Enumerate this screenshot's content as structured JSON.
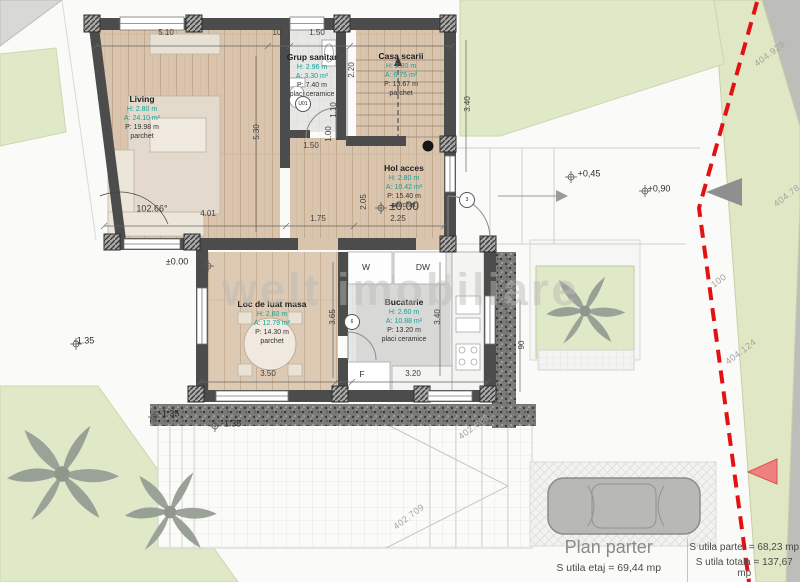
{
  "watermark": "welt imobiliare",
  "title_block": {
    "title": "Plan parter",
    "etaj": "S utila etaj = 69,44 mp",
    "parter": "S utila parter = 68,23 mp",
    "totala": "S utila totala = 137,67 mp"
  },
  "rooms": [
    {
      "name": "Living",
      "h": "H: 2.80 m",
      "a": "A: 24.10 m²",
      "p": "P: 19.98 m",
      "floor": "parchet"
    },
    {
      "name": "Grup sanitar",
      "h": "H: 2.96 m",
      "a": "A: 3.30 m²",
      "p": "P: 7.40 m",
      "floor": "placi ceramice"
    },
    {
      "name": "Casa scarii",
      "h": "H: 2.80 m",
      "a": "A: 6.75 m²",
      "p": "P: 13.67 m",
      "floor": "parchet"
    },
    {
      "name": "Hol acces",
      "h": "H: 2.80 m",
      "a": "A: 10.42 m²",
      "p": "P: 15.40 m",
      "floor": "parchet"
    },
    {
      "name": "Loc de luat masa",
      "h": "H: 2.60 m",
      "a": "A: 12.79 m²",
      "p": "P: 14.30 m",
      "floor": "parchet"
    },
    {
      "name": "Bucatarie",
      "h": "H: 2.60 m",
      "a": "A: 10.88 m²",
      "p": "P: 13.20 m",
      "floor": "placi ceramice"
    }
  ],
  "annotations": [
    {
      "text": "5.10",
      "x": 166,
      "y": 33,
      "cls": "dim",
      "name": "dimension-label"
    },
    {
      "text": "10",
      "x": 277,
      "y": 33,
      "cls": "dim",
      "name": "dimension-label"
    },
    {
      "text": "1.50",
      "x": 317,
      "y": 33,
      "cls": "dim",
      "name": "dimension-label"
    },
    {
      "text": "1.50",
      "x": 311,
      "y": 146,
      "cls": "dim",
      "name": "dimension-label"
    },
    {
      "text": "1.00",
      "x": 329,
      "y": 134,
      "cls": "dim v",
      "name": "dimension-label"
    },
    {
      "text": "1.10",
      "x": 334,
      "y": 110,
      "cls": "dim v",
      "name": "dimension-label"
    },
    {
      "text": "2.20",
      "x": 352,
      "y": 70,
      "cls": "dim v",
      "name": "dimension-label"
    },
    {
      "text": "3.40",
      "x": 468,
      "y": 104,
      "cls": "dim v",
      "name": "dimension-label"
    },
    {
      "text": "5.30",
      "x": 257,
      "y": 132,
      "cls": "dim v",
      "name": "dimension-label"
    },
    {
      "text": "4.01",
      "x": 208,
      "y": 214,
      "cls": "dim",
      "name": "dimension-label"
    },
    {
      "text": "1.75",
      "x": 318,
      "y": 219,
      "cls": "dim",
      "name": "dimension-label"
    },
    {
      "text": "2.25",
      "x": 398,
      "y": 219,
      "cls": "dim",
      "name": "dimension-label"
    },
    {
      "text": "2.05",
      "x": 364,
      "y": 202,
      "cls": "dim v",
      "name": "dimension-label"
    },
    {
      "text": "3.65",
      "x": 333,
      "y": 317,
      "cls": "dim v",
      "name": "dimension-label"
    },
    {
      "text": "3.40",
      "x": 438,
      "y": 317,
      "cls": "dim v",
      "name": "dimension-label"
    },
    {
      "text": "90",
      "x": 522,
      "y": 345,
      "cls": "dim v",
      "name": "dimension-label"
    },
    {
      "text": "3.50",
      "x": 268,
      "y": 374,
      "cls": "dim",
      "name": "dimension-label"
    },
    {
      "text": "3.20",
      "x": 413,
      "y": 374,
      "cls": "dim",
      "name": "dimension-label"
    },
    {
      "text": "102.66°",
      "x": 152,
      "y": 209,
      "cls": "angle",
      "name": "angle-label"
    },
    {
      "text": "±0.00",
      "x": 404,
      "y": 206,
      "cls": "lvl big",
      "name": "level-label"
    },
    {
      "text": "±0.00",
      "x": 177,
      "y": 262,
      "cls": "lvl",
      "name": "level-label"
    },
    {
      "text": "+0,45",
      "x": 589,
      "y": 174,
      "cls": "lvl",
      "name": "level-label"
    },
    {
      "text": "+0,90",
      "x": 659,
      "y": 189,
      "cls": "lvl",
      "name": "level-label"
    },
    {
      "text": "-1.35",
      "x": 84,
      "y": 341,
      "cls": "lvl",
      "name": "level-label"
    },
    {
      "text": "-1.35",
      "x": 169,
      "y": 414,
      "cls": "lvl",
      "name": "level-label"
    },
    {
      "text": "-1.35",
      "x": 231,
      "y": 424,
      "cls": "lvl",
      "name": "level-label"
    },
    {
      "text": "W",
      "x": 366,
      "y": 267,
      "cls": "app",
      "name": "appliance-label-washer"
    },
    {
      "text": "DW",
      "x": 423,
      "y": 267,
      "cls": "app",
      "name": "appliance-label-dishwasher"
    },
    {
      "text": "F",
      "x": 362,
      "y": 374,
      "cls": "app",
      "name": "appliance-label-fridge"
    },
    {
      "text": "U01",
      "x": 303,
      "y": 104,
      "cls": "tag",
      "name": "door-tag"
    },
    {
      "text": "3",
      "x": 467,
      "y": 200,
      "cls": "tag",
      "name": "window-tag"
    },
    {
      "text": "6",
      "x": 352,
      "y": 322,
      "cls": "tag",
      "name": "window-tag"
    },
    {
      "text": "404.928",
      "x": 770,
      "y": 54,
      "cls": "survey",
      "name": "survey-label"
    },
    {
      "text": "404.78",
      "x": 787,
      "y": 196,
      "cls": "survey",
      "name": "survey-label"
    },
    {
      "text": "100",
      "x": 719,
      "y": 281,
      "cls": "survey",
      "name": "survey-label"
    },
    {
      "text": "404.124",
      "x": 741,
      "y": 352,
      "cls": "survey",
      "name": "survey-label"
    },
    {
      "text": "402.868",
      "x": 474,
      "y": 427,
      "cls": "survey",
      "name": "survey-label"
    },
    {
      "text": "402.709",
      "x": 409,
      "y": 517,
      "cls": "survey",
      "name": "survey-label"
    }
  ],
  "colors": {
    "site_gray": "#e9e9e6",
    "plot_white": "#fafaf8",
    "grass_green": "#dfe9c8",
    "road_gray": "#bdbdba",
    "wood_floor": "#d9c4ae",
    "tile_floor": "#e7e7e5",
    "wall_dark": "#4c4c4c",
    "boundary_red": "#e31212",
    "room_value_teal": "#17a096",
    "title_gray": "#8a8a8a"
  }
}
